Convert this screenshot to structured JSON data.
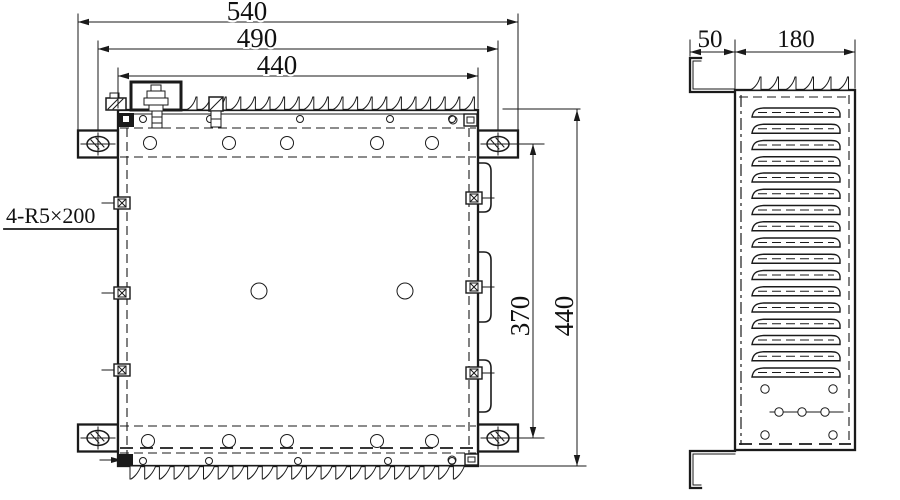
{
  "drawing": {
    "front_view": {
      "dim_width_outer": "540",
      "dim_width_holes": "490",
      "dim_width_body": "440",
      "dim_height_holes": "370",
      "dim_height_body": "440",
      "slot_note": "4-R5×200"
    },
    "side_view": {
      "dim_flange": "50",
      "dim_body_depth": "180"
    },
    "colors": {
      "line": "#1a1a1a",
      "background": "#ffffff"
    }
  }
}
